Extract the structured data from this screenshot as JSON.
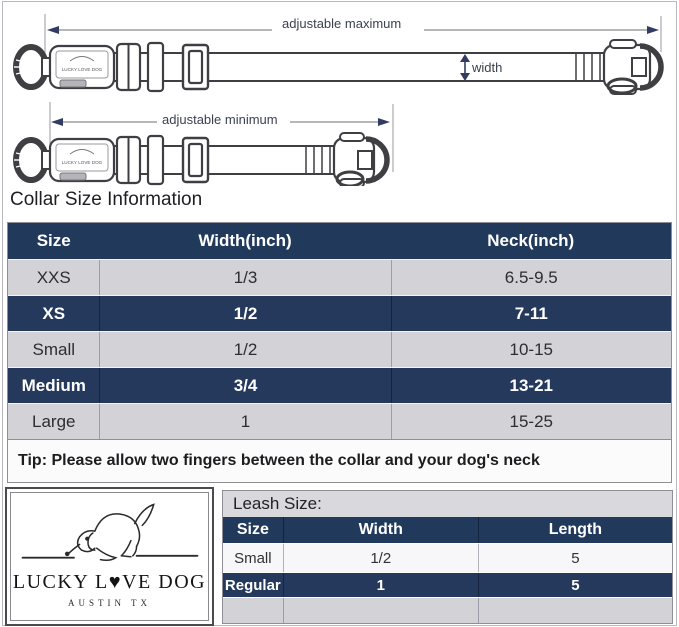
{
  "diagram": {
    "label_adjustable_maximum": "adjustable maximum",
    "label_adjustable_minimum": "adjustable minimum",
    "label_width": "width",
    "collar_brand_label": "LUCKY LOVE DOG"
  },
  "collar_section": {
    "title": "Collar Size Information",
    "table": {
      "headers": [
        "Size",
        "Width(inch)",
        "Neck(inch)"
      ],
      "rows": [
        {
          "size": "XXS",
          "width": "1/3",
          "neck": "6.5-9.5",
          "highlight": false
        },
        {
          "size": "XS",
          "width": "1/2",
          "neck": "7-11",
          "highlight": true
        },
        {
          "size": "Small",
          "width": "1/2",
          "neck": "10-15",
          "highlight": false
        },
        {
          "size": "Medium",
          "width": "3/4",
          "neck": "13-21",
          "highlight": true
        },
        {
          "size": "Large",
          "width": "1",
          "neck": "15-25",
          "highlight": false
        }
      ],
      "tip": "Tip: Please allow two fingers between the collar and your dog's neck"
    }
  },
  "logo": {
    "brand": "LUCKY L♥VE DOG",
    "location": "AUSTIN TX"
  },
  "leash_section": {
    "title": "Leash Size:",
    "table": {
      "headers": [
        "Size",
        "Width",
        "Length"
      ],
      "rows": [
        {
          "size": "Small",
          "width": "1/2",
          "length": "5",
          "highlight": false
        },
        {
          "size": "Regular",
          "width": "1",
          "length": "5",
          "highlight": true
        }
      ]
    }
  },
  "colors": {
    "header_navy": "#21395B",
    "row_navy": "#24395B",
    "row_gray": "#D2D2D7",
    "arrow_navy": "#323C63",
    "dim_line_gray": "#8C8C92"
  }
}
